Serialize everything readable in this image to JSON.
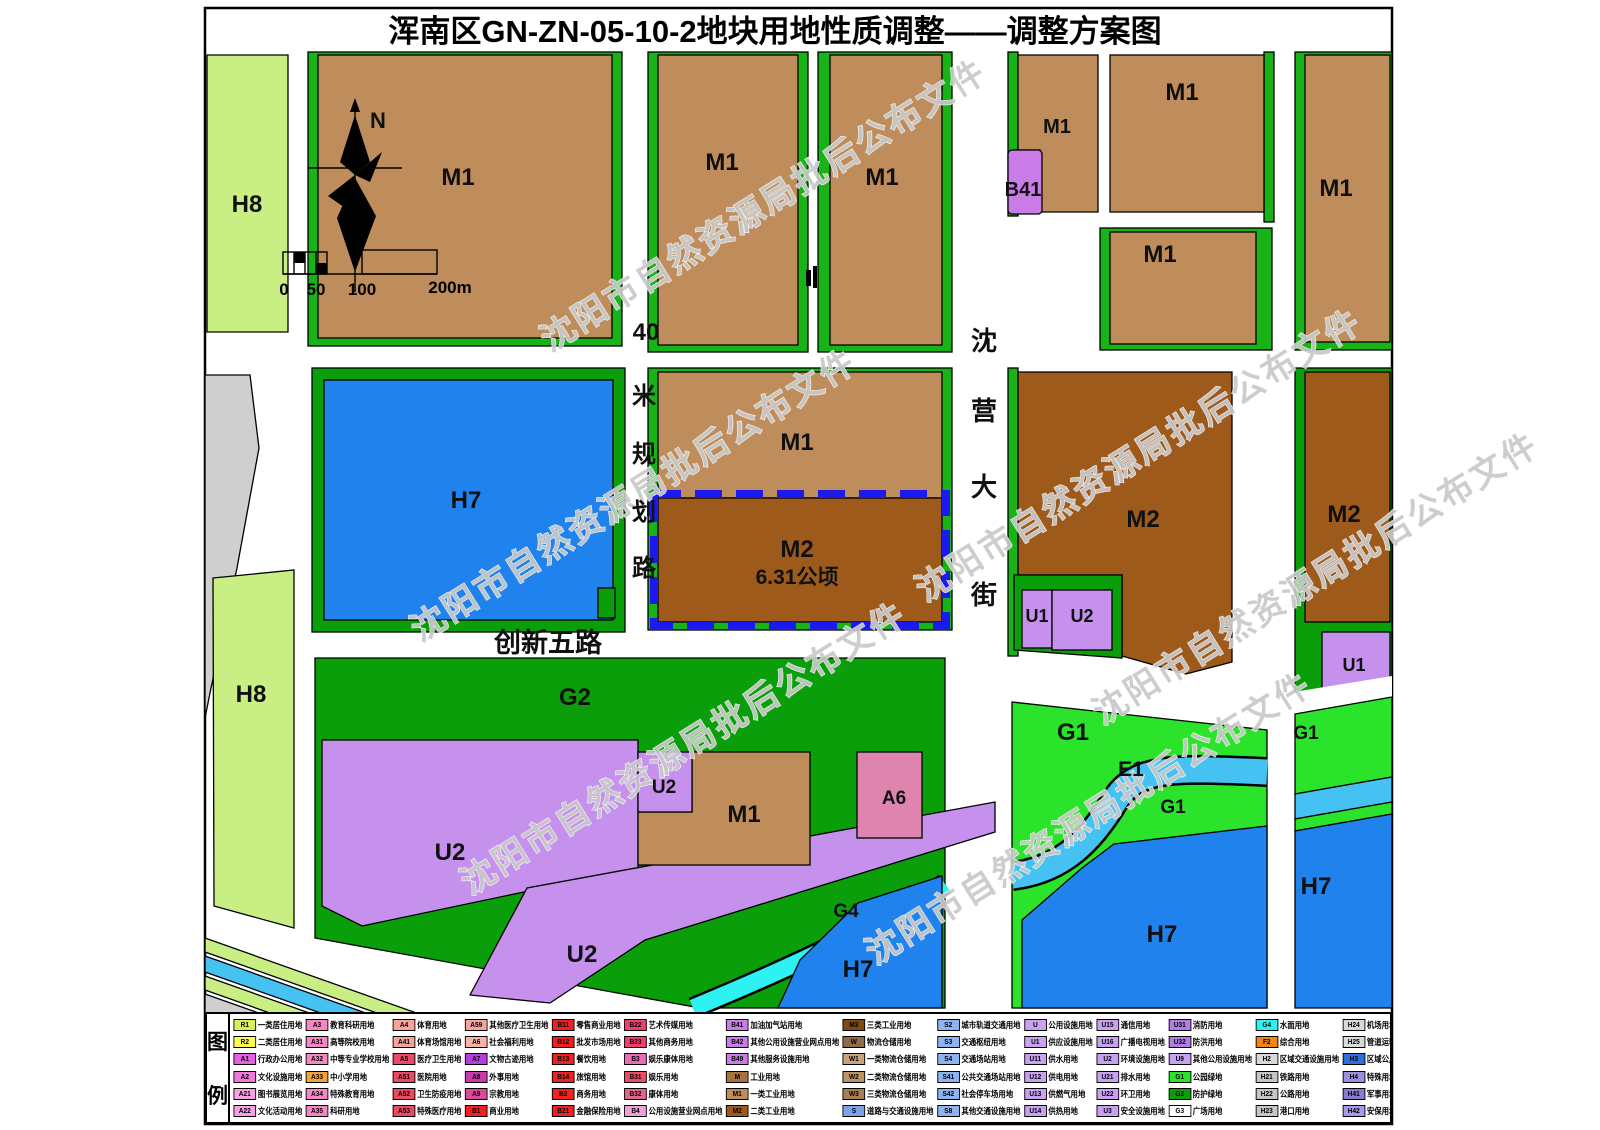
{
  "title": "浑南区GN-ZN-05-10-2地块用地性质调整——调整方案图",
  "watermark": {
    "text": "沈阳市自然资源局批后公布文件"
  },
  "north_label": "N",
  "scale": {
    "ticks": [
      "0",
      "50",
      "100",
      "200m"
    ]
  },
  "key_parcel": {
    "code": "M2",
    "area_label": "6.31公顷"
  },
  "palette": {
    "m1": "#bf8d5b",
    "m2": "#9d5a1b",
    "u": "#c591ec",
    "b41": "#c97ce8",
    "h7": "#2082ec",
    "h8": "#c9ef84",
    "g1": "#2be32b",
    "g2": "#0b9e0b",
    "strip": "#17b317",
    "g4": "#2ef2f2",
    "e1": "#46c2f2",
    "a6": "#de84ae",
    "gray": "#cfcfcf",
    "boundary": "#1a1af0"
  },
  "map_labels": [
    {
      "id": "h8-top",
      "text": "H8",
      "x": 247,
      "y": 212,
      "s": 24
    },
    {
      "id": "m1-nw",
      "text": "M1",
      "x": 458,
      "y": 185,
      "s": 24
    },
    {
      "id": "m1-n1",
      "text": "M1",
      "x": 722,
      "y": 170,
      "s": 24
    },
    {
      "id": "m1-n2",
      "text": "M1",
      "x": 882,
      "y": 185,
      "s": 24
    },
    {
      "id": "m1-ne1",
      "text": "M1",
      "x": 1057,
      "y": 133,
      "s": 20
    },
    {
      "id": "b41",
      "text": "B41",
      "x": 1023,
      "y": 196,
      "s": 20
    },
    {
      "id": "m1-ne2",
      "text": "M1",
      "x": 1182,
      "y": 100,
      "s": 24
    },
    {
      "id": "m1-ne3",
      "text": "M1",
      "x": 1160,
      "y": 262,
      "s": 24
    },
    {
      "id": "m1-e",
      "text": "M1",
      "x": 1336,
      "y": 196,
      "s": 24
    },
    {
      "id": "h7-w",
      "text": "H7",
      "x": 466,
      "y": 508,
      "s": 24
    },
    {
      "id": "m1-c",
      "text": "M1",
      "x": 797,
      "y": 450,
      "s": 24
    },
    {
      "id": "m2-key",
      "text": "M2",
      "x": 797,
      "y": 557,
      "s": 24
    },
    {
      "id": "m2-area",
      "text": "6.31公顷",
      "x": 797,
      "y": 584,
      "s": 21
    },
    {
      "id": "m2-e1",
      "text": "M2",
      "x": 1143,
      "y": 527,
      "s": 24
    },
    {
      "id": "u1-c",
      "text": "U1",
      "x": 1037,
      "y": 622,
      "s": 18
    },
    {
      "id": "u2-c",
      "text": "U2",
      "x": 1082,
      "y": 622,
      "s": 18
    },
    {
      "id": "m2-e2",
      "text": "M2",
      "x": 1344,
      "y": 522,
      "s": 24
    },
    {
      "id": "u1-e",
      "text": "U1",
      "x": 1354,
      "y": 671,
      "s": 18
    },
    {
      "id": "h8-low",
      "text": "H8",
      "x": 251,
      "y": 702,
      "s": 24
    },
    {
      "id": "g2",
      "text": "G2",
      "x": 575,
      "y": 705,
      "s": 24
    },
    {
      "id": "u2-big",
      "text": "U2",
      "x": 450,
      "y": 860,
      "s": 24
    },
    {
      "id": "u2-mid",
      "text": "U2",
      "x": 664,
      "y": 793,
      "s": 19
    },
    {
      "id": "m1-s",
      "text": "M1",
      "x": 744,
      "y": 822,
      "s": 24
    },
    {
      "id": "a6",
      "text": "A6",
      "x": 894,
      "y": 804,
      "s": 19
    },
    {
      "id": "g4",
      "text": "G4",
      "x": 846,
      "y": 917,
      "s": 19
    },
    {
      "id": "u2-low",
      "text": "U2",
      "x": 582,
      "y": 962,
      "s": 24
    },
    {
      "id": "h7-s",
      "text": "H7",
      "x": 858,
      "y": 977,
      "s": 24
    },
    {
      "id": "g1-1",
      "text": "G1",
      "x": 1073,
      "y": 740,
      "s": 24
    },
    {
      "id": "e1",
      "text": "E1",
      "x": 1131,
      "y": 776,
      "s": 21
    },
    {
      "id": "g1-2",
      "text": "G1",
      "x": 1173,
      "y": 813,
      "s": 19
    },
    {
      "id": "g1-e",
      "text": "G1",
      "x": 1306,
      "y": 739,
      "s": 19
    },
    {
      "id": "h7-se",
      "text": "H7",
      "x": 1162,
      "y": 942,
      "s": 24
    },
    {
      "id": "h7-e",
      "text": "H7",
      "x": 1316,
      "y": 894,
      "s": 24
    },
    {
      "id": "road40-0",
      "text": "40",
      "x": 646,
      "y": 340,
      "s": 24
    },
    {
      "id": "road40-1",
      "text": "米",
      "x": 644,
      "y": 404,
      "s": 24
    },
    {
      "id": "road40-2",
      "text": "规",
      "x": 644,
      "y": 462,
      "s": 24
    },
    {
      "id": "road40-3",
      "text": "划",
      "x": 644,
      "y": 520,
      "s": 24
    },
    {
      "id": "road40-4",
      "text": "路",
      "x": 644,
      "y": 576,
      "s": 24
    },
    {
      "id": "shenying-0",
      "text": "沈",
      "x": 984,
      "y": 350,
      "s": 26
    },
    {
      "id": "shenying-1",
      "text": "营",
      "x": 984,
      "y": 420,
      "s": 26
    },
    {
      "id": "shenying-2",
      "text": "大",
      "x": 984,
      "y": 496,
      "s": 26
    },
    {
      "id": "shenying-3",
      "text": "街",
      "x": 984,
      "y": 604,
      "s": 26
    },
    {
      "id": "chuangxin5",
      "text": "创新五路",
      "x": 548,
      "y": 652,
      "s": 27
    }
  ],
  "legend": {
    "header": [
      "图",
      "例"
    ],
    "items": [
      {
        "c": "R1",
        "l": "一类居住用地",
        "bg": "#d7f054"
      },
      {
        "c": "R2",
        "l": "二类居住用地",
        "bg": "#ffff4d"
      },
      {
        "c": "A1",
        "l": "行政办公用地",
        "bg": "#e35fe3"
      },
      {
        "c": "A2",
        "l": "文化设施用地",
        "bg": "#f07ad8"
      },
      {
        "c": "A21",
        "l": "图书展览用地",
        "bg": "#f5a3e6"
      },
      {
        "c": "A22",
        "l": "文化活动用地",
        "bg": "#f5a3e6"
      },
      {
        "c": "A3",
        "l": "教育科研用地",
        "bg": "#f588c4"
      },
      {
        "c": "A31",
        "l": "高等院校用地",
        "bg": "#f588c4"
      },
      {
        "c": "A32",
        "l": "中等专业学校用地",
        "bg": "#f588c4"
      },
      {
        "c": "A33",
        "l": "中小学用地",
        "bg": "#f2a33a"
      },
      {
        "c": "A34",
        "l": "特殊教育用地",
        "bg": "#f588c4"
      },
      {
        "c": "A35",
        "l": "科研用地",
        "bg": "#f588c4"
      },
      {
        "c": "A4",
        "l": "体育用地",
        "bg": "#f5a59e"
      },
      {
        "c": "A41",
        "l": "体育场馆用地",
        "bg": "#f5a59e"
      },
      {
        "c": "A5",
        "l": "医疗卫生用地",
        "bg": "#ea4a63"
      },
      {
        "c": "A51",
        "l": "医院用地",
        "bg": "#ea4a63"
      },
      {
        "c": "A52",
        "l": "卫生防疫用地",
        "bg": "#ea4a63"
      },
      {
        "c": "A53",
        "l": "特殊医疗用地",
        "bg": "#ea4a63"
      },
      {
        "c": "A59",
        "l": "其他医疗卫生用地",
        "bg": "#f5a59e"
      },
      {
        "c": "A6",
        "l": "社会福利用地",
        "bg": "#f5b3ab"
      },
      {
        "c": "A7",
        "l": "文物古迹用地",
        "bg": "#b33fd9"
      },
      {
        "c": "A8",
        "l": "外事用地",
        "bg": "#c93bab"
      },
      {
        "c": "A9",
        "l": "宗教用地",
        "bg": "#d94a99"
      },
      {
        "c": "B1",
        "l": "商业用地",
        "bg": "#f22020"
      },
      {
        "c": "B11",
        "l": "零售商业用地",
        "bg": "#f22020"
      },
      {
        "c": "B12",
        "l": "批发市场用地",
        "bg": "#f22020"
      },
      {
        "c": "B13",
        "l": "餐饮用地",
        "bg": "#f22020"
      },
      {
        "c": "B14",
        "l": "旅馆用地",
        "bg": "#f22020"
      },
      {
        "c": "B2",
        "l": "商务用地",
        "bg": "#f22020"
      },
      {
        "c": "B21",
        "l": "金融保险用地",
        "bg": "#f22020"
      },
      {
        "c": "B22",
        "l": "艺术传媒用地",
        "bg": "#f23d6e"
      },
      {
        "c": "B23",
        "l": "其他商务用地",
        "bg": "#f23d6e"
      },
      {
        "c": "B3",
        "l": "娱乐康体用地",
        "bg": "#ea6cb8"
      },
      {
        "c": "B31",
        "l": "娱乐用地",
        "bg": "#f24a66"
      },
      {
        "c": "B32",
        "l": "康体用地",
        "bg": "#e06888"
      },
      {
        "c": "B4",
        "l": "公用设施营业网点用地",
        "bg": "#f0a0d8"
      },
      {
        "c": "B41",
        "l": "加油加气站用地",
        "bg": "#c97ce8"
      },
      {
        "c": "B42",
        "l": "其他公用设施营业网点用地",
        "bg": "#c97ce8"
      },
      {
        "c": "B49",
        "l": "其他服务设施用地",
        "bg": "#c97ce8"
      },
      {
        "c": "M",
        "l": "工业用地",
        "bg": "#a8713d"
      },
      {
        "c": "M1",
        "l": "一类工业用地",
        "bg": "#bf8d5b"
      },
      {
        "c": "M2",
        "l": "二类工业用地",
        "bg": "#9d5a1b"
      },
      {
        "c": "M3",
        "l": "三类工业用地",
        "bg": "#7d4a12"
      },
      {
        "c": "W",
        "l": "物流仓储用地",
        "bg": "#8f6b46"
      },
      {
        "c": "W1",
        "l": "一类物流仓储用地",
        "bg": "#caa379"
      },
      {
        "c": "W2",
        "l": "二类物流仓储用地",
        "bg": "#bd9466"
      },
      {
        "c": "W3",
        "l": "三类物流仓储用地",
        "bg": "#a87f52"
      },
      {
        "c": "S",
        "l": "道路与交通设施用地",
        "bg": "#7aa3e8"
      },
      {
        "c": "S2",
        "l": "城市轨道交通用地",
        "bg": "#8fb3f0"
      },
      {
        "c": "S3",
        "l": "交通枢纽用地",
        "bg": "#8fb3f0"
      },
      {
        "c": "S4",
        "l": "交通场站用地",
        "bg": "#8fb3f0"
      },
      {
        "c": "S41",
        "l": "公共交通场站用地",
        "bg": "#8fb3f0"
      },
      {
        "c": "S42",
        "l": "社会停车场用地",
        "bg": "#8fb3f0"
      },
      {
        "c": "S8",
        "l": "其他交通设施用地",
        "bg": "#8fb3f0"
      },
      {
        "c": "U",
        "l": "公用设施用地",
        "bg": "#c9a1f0"
      },
      {
        "c": "U1",
        "l": "供应设施用地",
        "bg": "#c9a1f0"
      },
      {
        "c": "U11",
        "l": "供水用地",
        "bg": "#c9a1f0"
      },
      {
        "c": "U12",
        "l": "供电用地",
        "bg": "#c9a1f0"
      },
      {
        "c": "U13",
        "l": "供燃气用地",
        "bg": "#c9a1f0"
      },
      {
        "c": "U14",
        "l": "供热用地",
        "bg": "#c9a1f0"
      },
      {
        "c": "U15",
        "l": "通信用地",
        "bg": "#c9a1f0"
      },
      {
        "c": "U16",
        "l": "广播电视用地",
        "bg": "#c9a1f0"
      },
      {
        "c": "U2",
        "l": "环境设施用地",
        "bg": "#c9a1f0"
      },
      {
        "c": "U21",
        "l": "排水用地",
        "bg": "#c9a1f0"
      },
      {
        "c": "U22",
        "l": "环卫用地",
        "bg": "#c9a1f0"
      },
      {
        "c": "U3",
        "l": "安全设施用地",
        "bg": "#c9a1f0"
      },
      {
        "c": "U31",
        "l": "消防用地",
        "bg": "#b07de3"
      },
      {
        "c": "U32",
        "l": "防洪用地",
        "bg": "#b07de3"
      },
      {
        "c": "U9",
        "l": "其他公用设施用地",
        "bg": "#c9a1f0"
      },
      {
        "c": "G1",
        "l": "公园绿地",
        "bg": "#2be32b"
      },
      {
        "c": "G2",
        "l": "防护绿地",
        "bg": "#0b9e0b"
      },
      {
        "c": "G3",
        "l": "广场用地",
        "bg": "#ffffff"
      },
      {
        "c": "G4",
        "l": "水面用地",
        "bg": "#2ef2f2"
      },
      {
        "c": "F2",
        "l": "综合用地",
        "bg": "#f2851a"
      },
      {
        "c": "H2",
        "l": "区域交通设施用地",
        "bg": "#d9d9d9"
      },
      {
        "c": "H21",
        "l": "铁路用地",
        "bg": "#c6c6c6"
      },
      {
        "c": "H22",
        "l": "公路用地",
        "bg": "#c6c6c6"
      },
      {
        "c": "H23",
        "l": "港口用地",
        "bg": "#c6c6c6"
      },
      {
        "c": "H24",
        "l": "机场用地",
        "bg": "#d9d9d9"
      },
      {
        "c": "H25",
        "l": "管道运输用地",
        "bg": "#d9d9d9"
      },
      {
        "c": "H3",
        "l": "区域公用设施用地",
        "bg": "#2f6fd9"
      },
      {
        "c": "H4",
        "l": "特殊用地",
        "bg": "#9a8fe0"
      },
      {
        "c": "H41",
        "l": "军事用地",
        "bg": "#8a7ad0"
      },
      {
        "c": "H42",
        "l": "安保用地",
        "bg": "#a89ae8"
      },
      {
        "c": "H5",
        "l": "采矿用地",
        "bg": "#c9b264"
      },
      {
        "c": "H6",
        "l": "留用地",
        "bg": "#d6ea8f"
      },
      {
        "c": "H7",
        "l": "备用地",
        "bg": "#2082ec"
      },
      {
        "c": "H8",
        "l": "区域绿地",
        "bg": "#c9ef84"
      },
      {
        "c": "H9",
        "l": "独立建设用地",
        "bg": "#c2bb5e"
      },
      {
        "c": "E1",
        "l": "水域",
        "bg": "#46c2f2"
      },
      {
        "c": "E2",
        "l": "农用地",
        "bg": "#dff2a6"
      },
      {
        "c": "E3",
        "l": "生态林地",
        "bg": "#2d7a2d"
      },
      {
        "c": "E4",
        "l": "防护林地",
        "bg": "#2ee82e"
      },
      {
        "c": "E9",
        "l": "其他非建设用地",
        "bg": "#99a04d"
      },
      {
        "type": "dash",
        "l": "地块界线"
      },
      {
        "type": "empty",
        "l": ""
      }
    ]
  }
}
